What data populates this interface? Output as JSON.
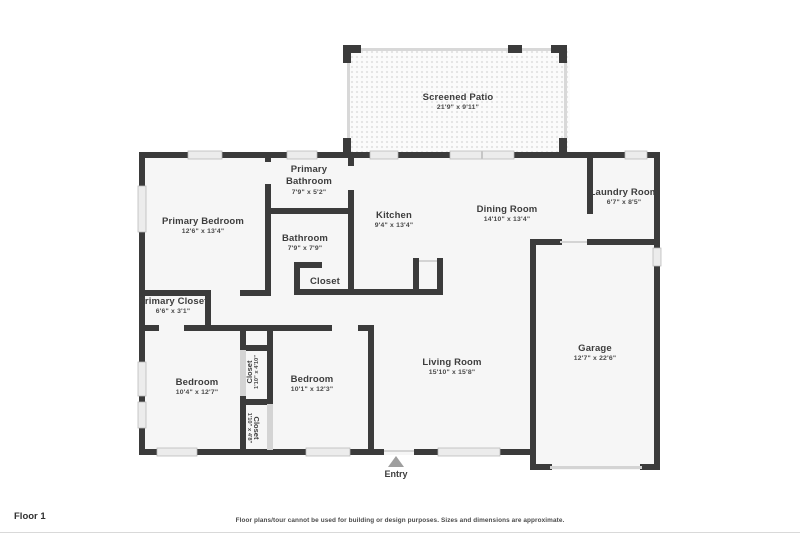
{
  "floor_label": "Floor 1",
  "disclaimer": "Floor plans/tour cannot be used for building or design purposes. Sizes and dimensions are approximate.",
  "entry": {
    "label": "Entry"
  },
  "colors": {
    "wall": "#3b3b3b",
    "room_fill": "#f6f6f6",
    "window_fill": "#ececec",
    "window_border": "#b8b8b8",
    "screen_wall": "#d8d8d8",
    "door_line": "#d4d4d4",
    "label_text": "#3d3d3d",
    "entry_arrow": "#9e9e9e"
  },
  "rooms": [
    {
      "id": "screened-patio",
      "name": "Screened Patio",
      "dims": "21'9\" x 9'11\""
    },
    {
      "id": "primary-bedroom",
      "name": "Primary Bedroom",
      "dims": "12'6\" x 13'4\""
    },
    {
      "id": "primary-bathroom",
      "name": "Primary Bathroom",
      "dims": "7'9\" x 5'2\""
    },
    {
      "id": "bathroom",
      "name": "Bathroom",
      "dims": "7'9\" x 7'9\""
    },
    {
      "id": "hall-closet",
      "name": "Closet",
      "dims": ""
    },
    {
      "id": "primary-closet",
      "name": "Primary Closet",
      "dims": "6'6\" x 3'1\""
    },
    {
      "id": "kitchen",
      "name": "Kitchen",
      "dims": "9'4\" x 13'4\""
    },
    {
      "id": "dining-room",
      "name": "Dining Room",
      "dims": "14'10\" x 13'4\""
    },
    {
      "id": "laundry-room",
      "name": "Laundry Room",
      "dims": "6'7\" x 8'5\""
    },
    {
      "id": "bedroom-1",
      "name": "Bedroom",
      "dims": "10'4\" x 12'7\""
    },
    {
      "id": "closet-upper",
      "name": "Closet",
      "dims": "1'10\" x 4'10\""
    },
    {
      "id": "closet-lower",
      "name": "Closet",
      "dims": "1'10\" x 4'8\""
    },
    {
      "id": "bedroom-2",
      "name": "Bedroom",
      "dims": "10'1\" x 12'3\""
    },
    {
      "id": "living-room",
      "name": "Living Room",
      "dims": "15'10\" x 15'8\""
    },
    {
      "id": "garage",
      "name": "Garage",
      "dims": "12'7\" x 22'6\""
    }
  ]
}
